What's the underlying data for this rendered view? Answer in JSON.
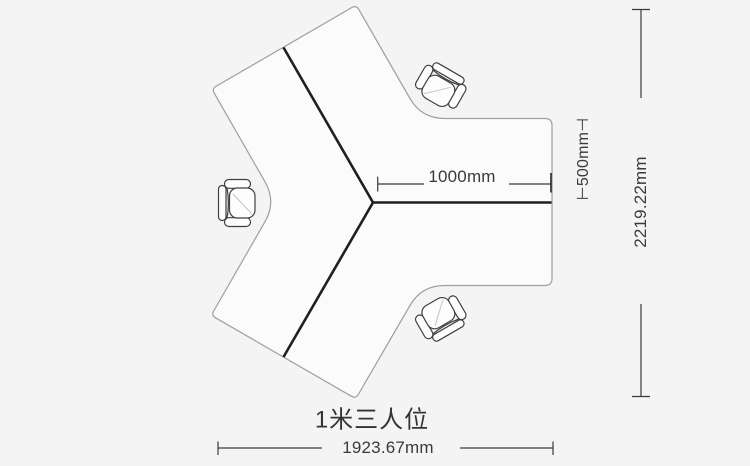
{
  "page": {
    "background_color": "#f4f4f4"
  },
  "diagram": {
    "caption": "1米三人位",
    "desk": {
      "description": "Y-shaped three-person workstation, top view",
      "seats": 3,
      "fill_color": "#fbfbfb",
      "outline_color": "#9e9e9e",
      "divider_color": "#1f1f1f"
    },
    "chairs": [
      {
        "position": "left",
        "facing": "right"
      },
      {
        "position": "top-right",
        "facing": "down-left"
      },
      {
        "position": "bottom-right",
        "facing": "up-left"
      }
    ],
    "dimensions": {
      "desk_length": {
        "label": "1000mm",
        "value_mm": 1000
      },
      "desk_depth": {
        "label": "⊢500mm⊣",
        "value_mm": 500
      },
      "overall_height": {
        "label": "2219.22mm",
        "value_mm": 2219.22
      },
      "overall_width": {
        "label": "1923.67mm",
        "value_mm": 1923.67
      }
    }
  }
}
